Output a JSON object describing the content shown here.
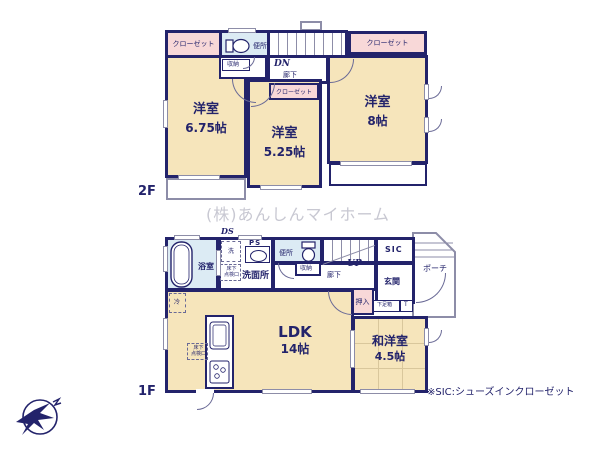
{
  "watermark": "(株)あんしんマイホーム",
  "footnote": "※SIC:シューズインクローゼット",
  "colors": {
    "wall": "#23236b",
    "room_fill": "#f6e5bb",
    "closet_fill": "#f8d8d8",
    "wet_fill": "#dcebf4",
    "watermark": "#c8c8d2"
  },
  "f2": {
    "label": "2F",
    "closet_left": "クローゼット",
    "closet_right": "クローゼット",
    "closet_mid": "クローゼット",
    "toilet": "便所",
    "storage": "収納",
    "stairs_dn": "DN",
    "hallway": "廊下",
    "room_w": {
      "name": "洋室",
      "size": "6.75帖"
    },
    "room_c": {
      "name": "洋室",
      "size": "5.25帖"
    },
    "room_e": {
      "name": "洋室",
      "size": "8帖"
    }
  },
  "f1": {
    "label": "1F",
    "ds": "DS",
    "ps": "PS",
    "bath": "浴室",
    "laundry": "洗",
    "washroom": "洗面所",
    "hatch_line1": "床下",
    "hatch_line2": "点検口",
    "toilet": "便所",
    "storage": "収納",
    "hallway": "廊下",
    "stairs_up": "UP",
    "sic": "SIC",
    "entrance": "玄関",
    "shoebox": "下足箱",
    "shoebox_t": "T",
    "oshiire": "押入",
    "porch": "ポーチ",
    "fridge": "冷",
    "ldk": {
      "name": "LDK",
      "size": "14帖"
    },
    "washitsu": {
      "name": "和洋室",
      "size": "4.5帖"
    }
  }
}
